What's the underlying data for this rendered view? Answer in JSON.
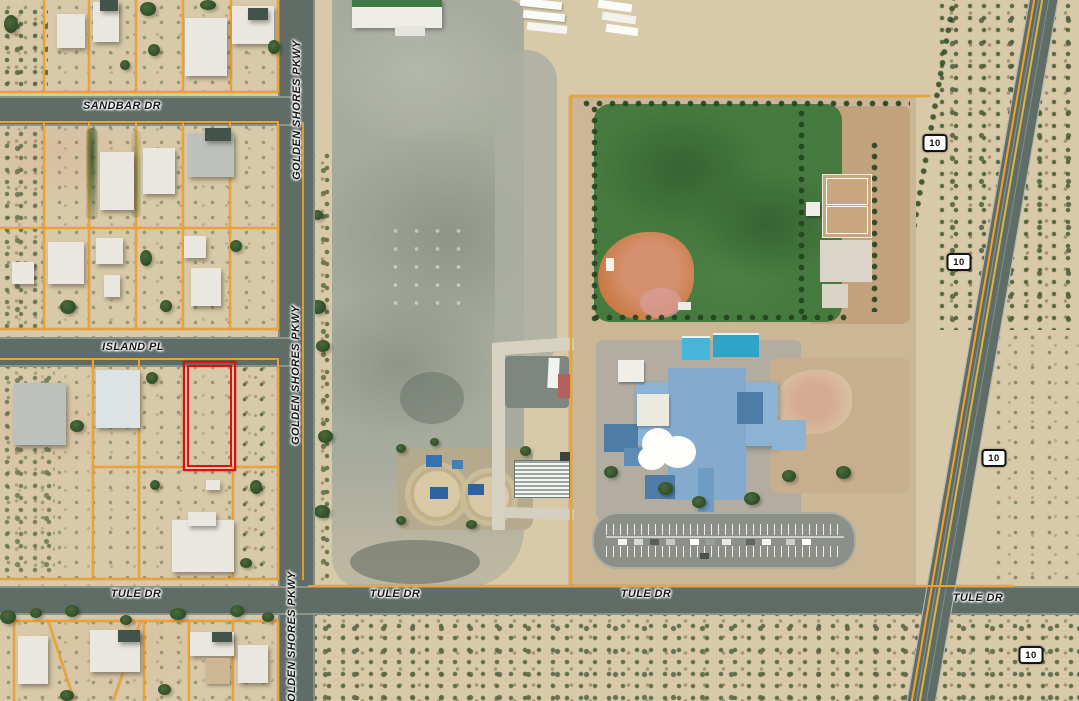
{
  "map_labels": {
    "sandbar_dr": "SANDBAR DR",
    "island_pl": "ISLAND PL",
    "tule_dr": "TULE DR",
    "golden_shores_pkwy": "GOLDEN SHORES PKWY"
  },
  "highway_shield": "10",
  "colors": {
    "parcel_line": "#f0a22e",
    "subject_parcel_outline": "#dd1010",
    "highway_centerline": "#e0b23f",
    "school_field_green": "#477a40",
    "baseball_infield": "#c97840"
  }
}
